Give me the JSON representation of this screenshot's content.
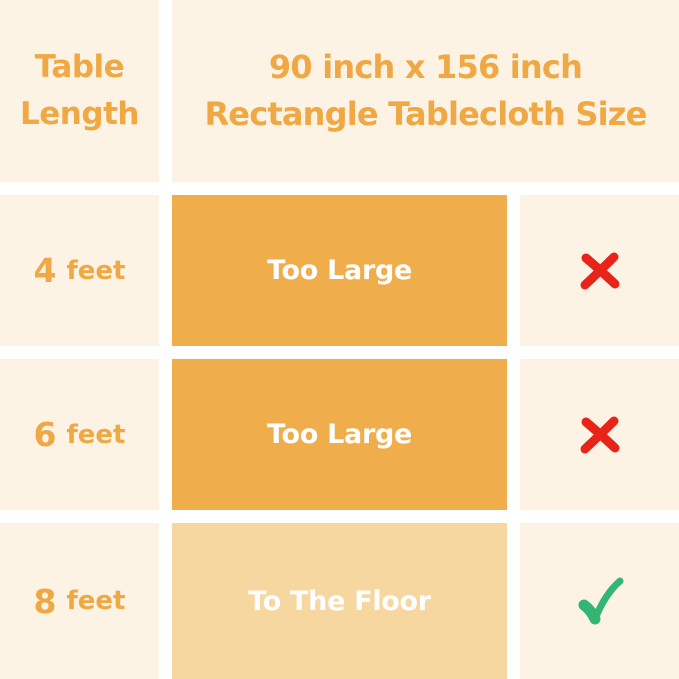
{
  "colors": {
    "cream": "#FCF3E4",
    "orange": "#F0AD4B",
    "orange_light": "#F6D79F",
    "orange_text": "#EFA843",
    "white": "#FFFFFF",
    "red": "#E82319",
    "green": "#33B573"
  },
  "header": {
    "row_label_line1": "Table",
    "row_label_line2": "Length",
    "title_line1": "90 inch x 156 inch",
    "title_line2": "Rectangle Tablecloth Size"
  },
  "rows": [
    {
      "length_value": "4",
      "length_unit": "feet",
      "fit_label": "Too Large",
      "verdict": "no"
    },
    {
      "length_value": "6",
      "length_unit": "feet",
      "fit_label": "Too Large",
      "verdict": "no"
    },
    {
      "length_value": "8",
      "length_unit": "feet",
      "fit_label": "To The Floor",
      "verdict": "yes"
    }
  ],
  "icons": {
    "cross": "red-cross-mark",
    "check": "green-check-mark"
  }
}
